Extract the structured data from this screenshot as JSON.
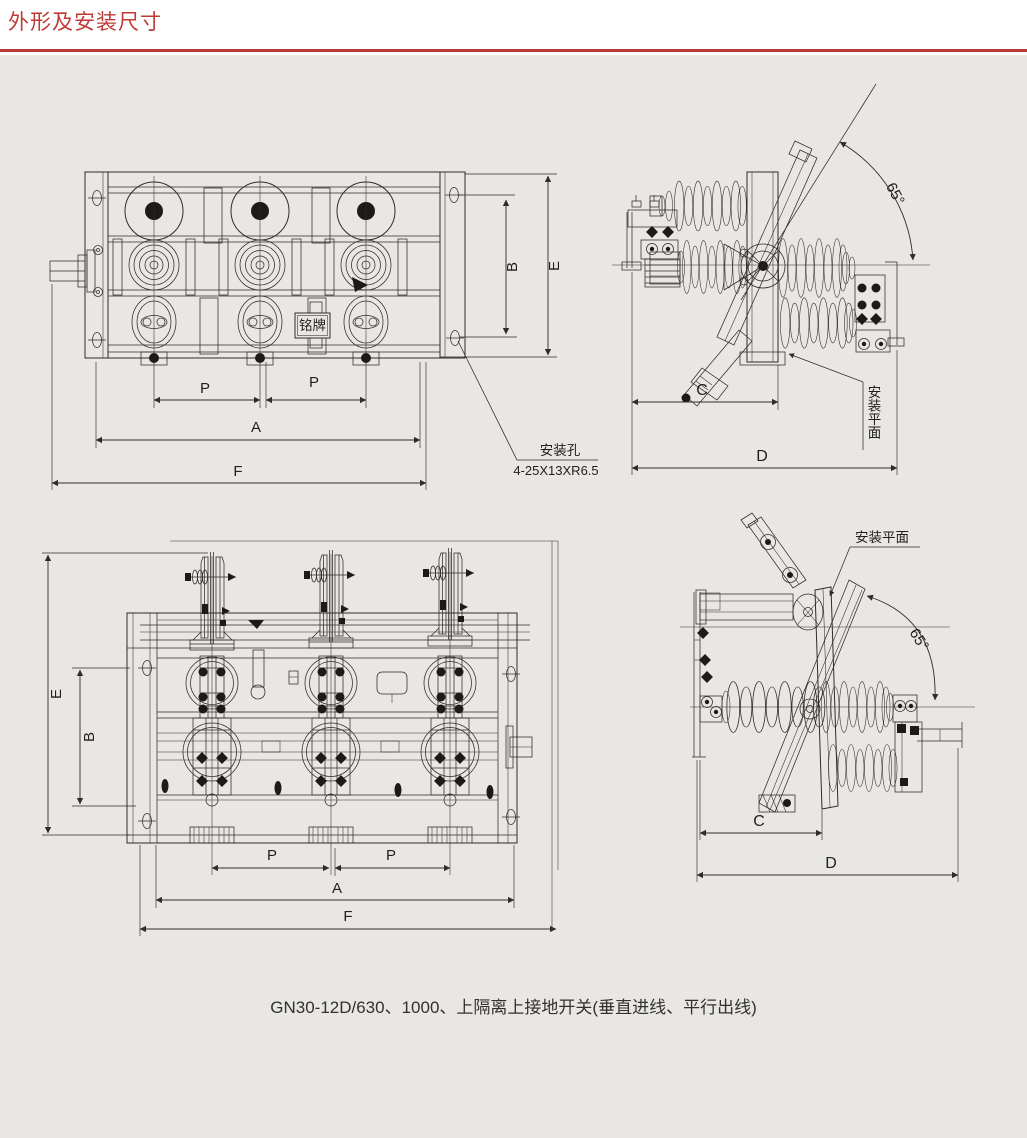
{
  "page": {
    "title": "外形及安装尺寸",
    "caption": "GN30-12D/630、1000、上隔离上接地开关(垂直进线、平行出线)"
  },
  "colors": {
    "accent": "#bf3b36",
    "line": "#2f2c2b",
    "background": "#e8e7e4"
  },
  "labels": {
    "dim_A": "A",
    "dim_B": "B",
    "dim_C": "C",
    "dim_D": "D",
    "dim_E": "E",
    "dim_F": "F",
    "dim_P": "P",
    "angle_65": "65°",
    "mounting_plane": "安装平面",
    "mounting_hole": "安装孔",
    "mounting_hole_spec": "4-25X13XR6.5",
    "nameplate": "铭牌"
  }
}
